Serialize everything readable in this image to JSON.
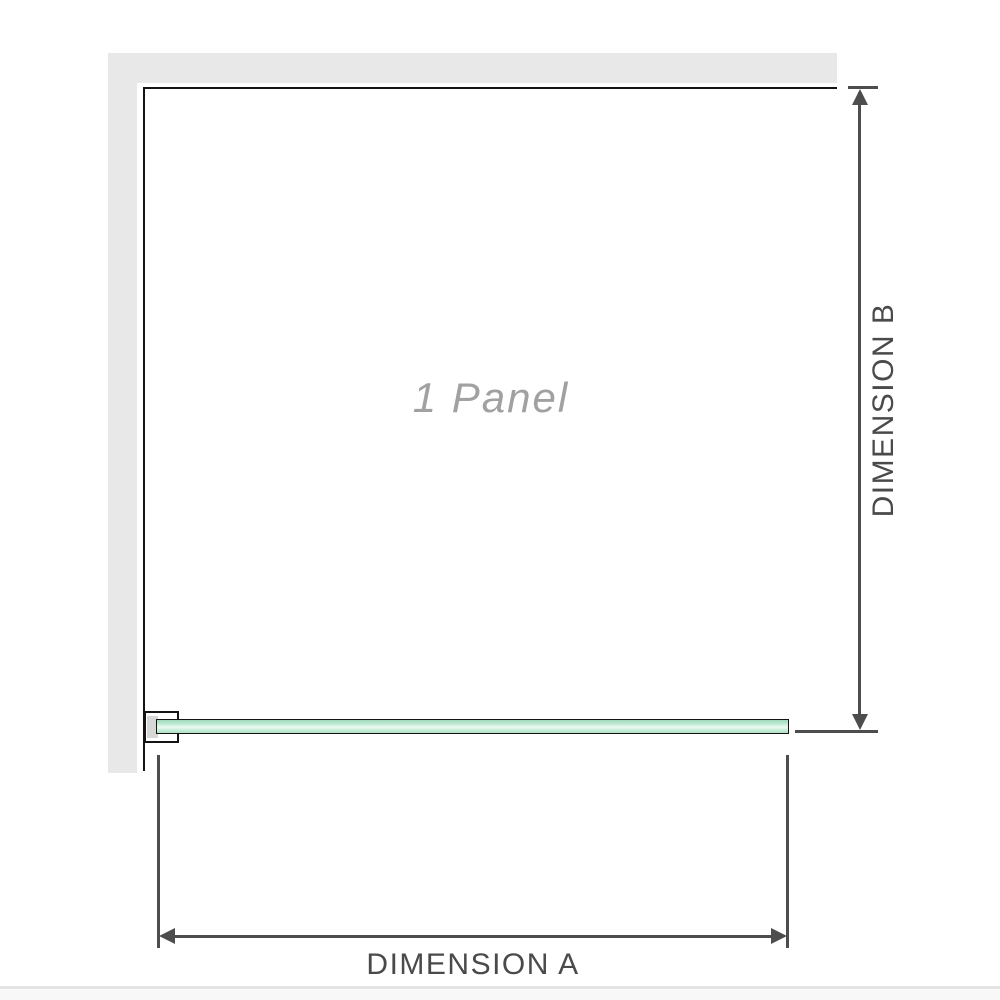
{
  "diagram": {
    "panel_label": "1 Panel",
    "dimensions": {
      "a_label": "DIMENSION A",
      "b_label": "DIMENSION B"
    },
    "icons": {
      "arrow_up": "arrow-up-icon",
      "arrow_down": "arrow-down-icon",
      "arrow_left": "arrow-left-icon",
      "arrow_right": "arrow-right-icon"
    },
    "colors": {
      "wall_gray": "#e8e8e8",
      "outline_black": "#141414",
      "dimension_gray": "#4d4d4d",
      "label_gray": "#a1a1a1",
      "glass_green": "#bfe9d2",
      "glass_highlight": "#ecfaf2",
      "bracket_pad_gray": "#d7d7d7",
      "page_edge_gray": "#e4e4e4"
    }
  }
}
